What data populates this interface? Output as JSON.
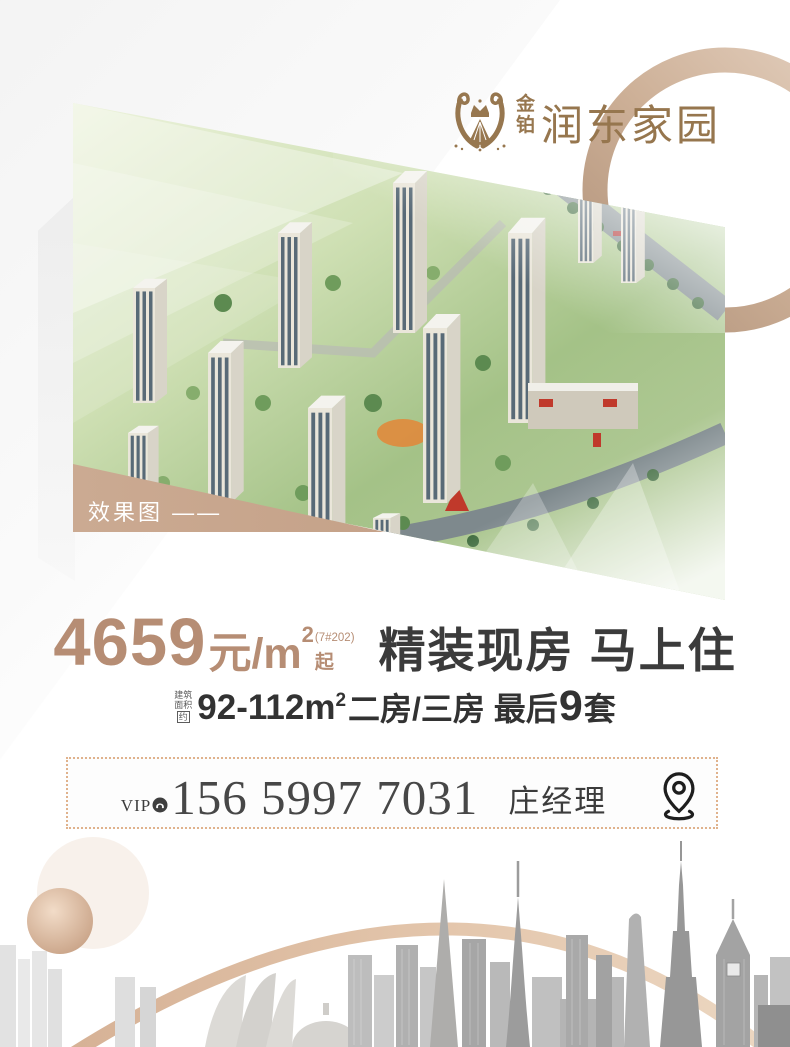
{
  "logo": {
    "brand_top": "金",
    "brand_bottom": "铂",
    "name": "润东家园"
  },
  "hero": {
    "tag": "效果图 ——"
  },
  "price": {
    "number": "4659",
    "unit": "元/m",
    "unit_sup": "2",
    "note": "(7#202)",
    "suffix": "起",
    "headline": "精装现房 马上住"
  },
  "specs": {
    "prefix_line1": "建筑",
    "prefix_line2": "面积",
    "prefix_boxed": "约",
    "area": "92-112m",
    "area_sup": "2",
    "rooms": "二房/三房 最后",
    "count": "9",
    "count_suffix": "套"
  },
  "contact": {
    "vip_label": "VIP",
    "phone": "156 5997 7031",
    "manager": "庄经理"
  },
  "icons": {
    "emblem": "lyre-crown-emblem",
    "phone_badge": "phone-circle",
    "pin": "location-pin"
  },
  "colors": {
    "bronze": "#97774f",
    "price_accent": "#b68d74",
    "band_tan": "#c9a78f",
    "dot_border": "#e0b28c",
    "text_dark": "#3b3b3b"
  }
}
